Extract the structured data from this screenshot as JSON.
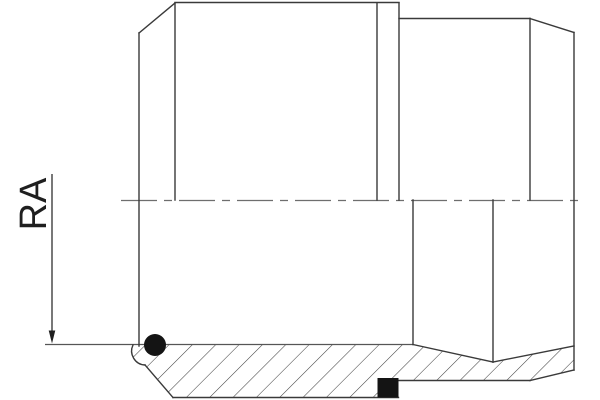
{
  "drawing": {
    "dimension_label": "RA",
    "view": "half-section technical drawing of a weld-cone fitting with O-ring and seal ring"
  },
  "colors": {
    "background": "#ffffff",
    "outline": "#3a3a3a",
    "centerline": "#6e6e6e",
    "aux_line": "#565656",
    "dimension": "#1f1f1f",
    "hatch": "#3c3c3c",
    "fill_black": "#141414"
  }
}
